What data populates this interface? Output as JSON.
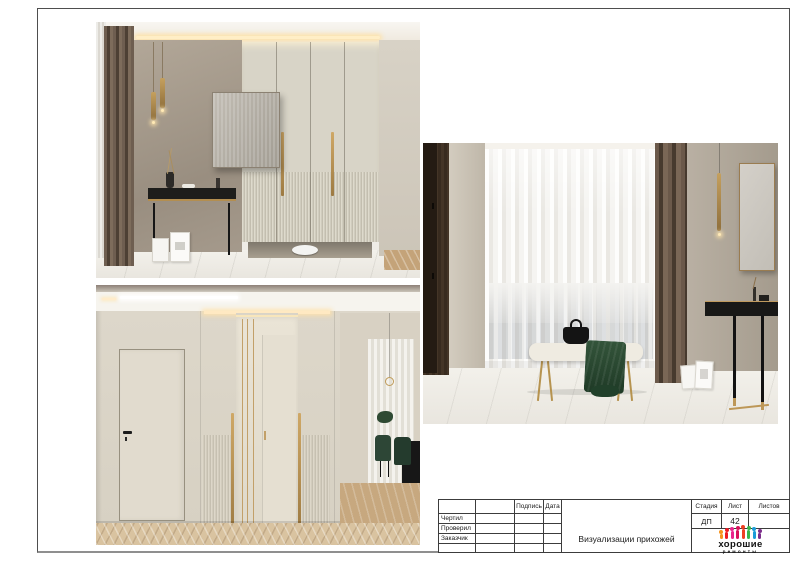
{
  "title_block": {
    "rows": [
      "Чертил",
      "Проверил",
      "Заказчик"
    ],
    "signature_header": "Подпись",
    "date_header": "Дата",
    "stage_header": "Стадия",
    "sheet_header": "Лист",
    "sheets_total_header": "Листов",
    "stage_value": "ДП",
    "sheet_value": "42",
    "sheets_total_value": "",
    "project_title": "Визуализации прихожей"
  },
  "logo": {
    "line1": "хорошие",
    "line2": "ремонты",
    "icon": "people-row-icon",
    "colors": [
      "#f7941d",
      "#ed1c24",
      "#e9258c",
      "#d8125b",
      "#ef3f23",
      "#39b54a",
      "#1b9cd8",
      "#7b2d8b"
    ]
  }
}
